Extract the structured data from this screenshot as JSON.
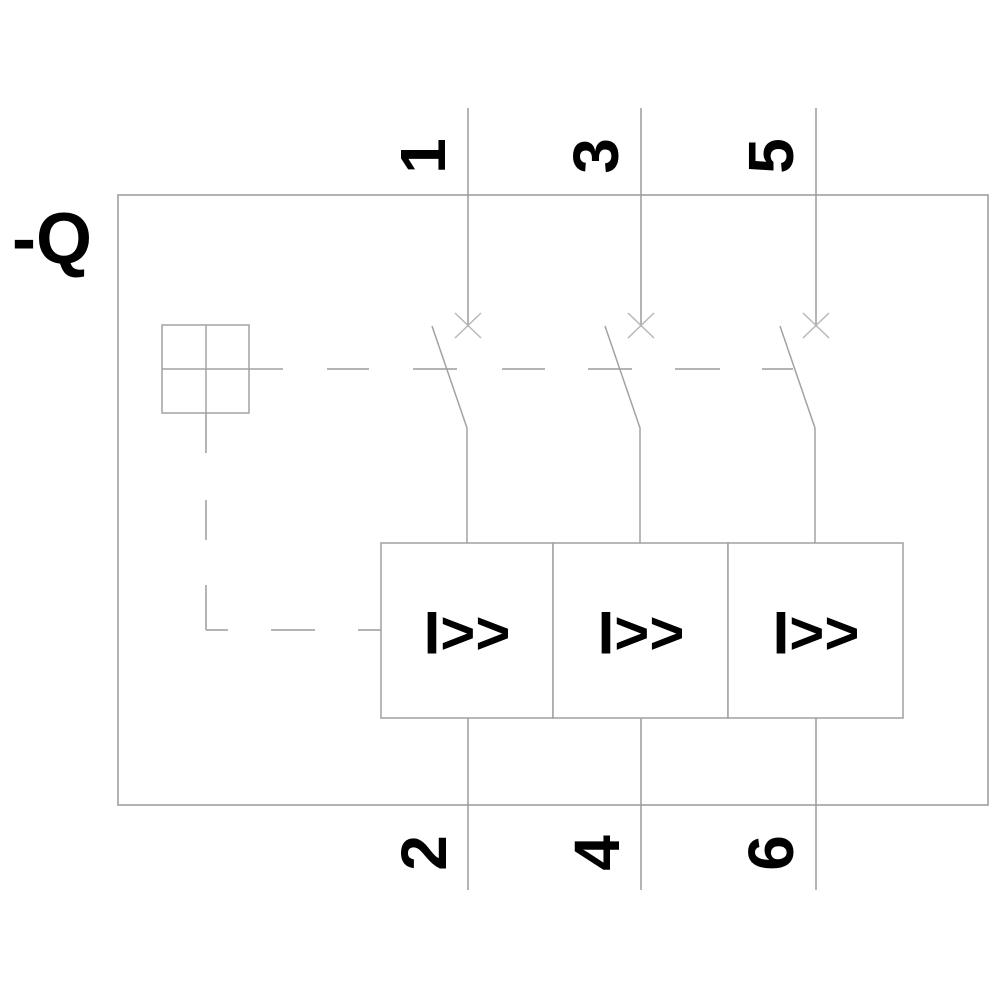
{
  "diagram": {
    "type": "circuit-breaker-schematic",
    "device_label": "-Q",
    "poles": [
      {
        "top_terminal": "1",
        "bottom_terminal": "2",
        "trip_symbol": "I>>"
      },
      {
        "top_terminal": "3",
        "bottom_terminal": "4",
        "trip_symbol": "I>>"
      },
      {
        "top_terminal": "5",
        "bottom_terminal": "6",
        "trip_symbol": "I>>"
      }
    ],
    "colors": {
      "background": "#ffffff",
      "line": "#9b9b9b",
      "enclosure_border": "#b2b2b2",
      "contact_mark": "#b8b8b8",
      "text": "#000000"
    }
  }
}
